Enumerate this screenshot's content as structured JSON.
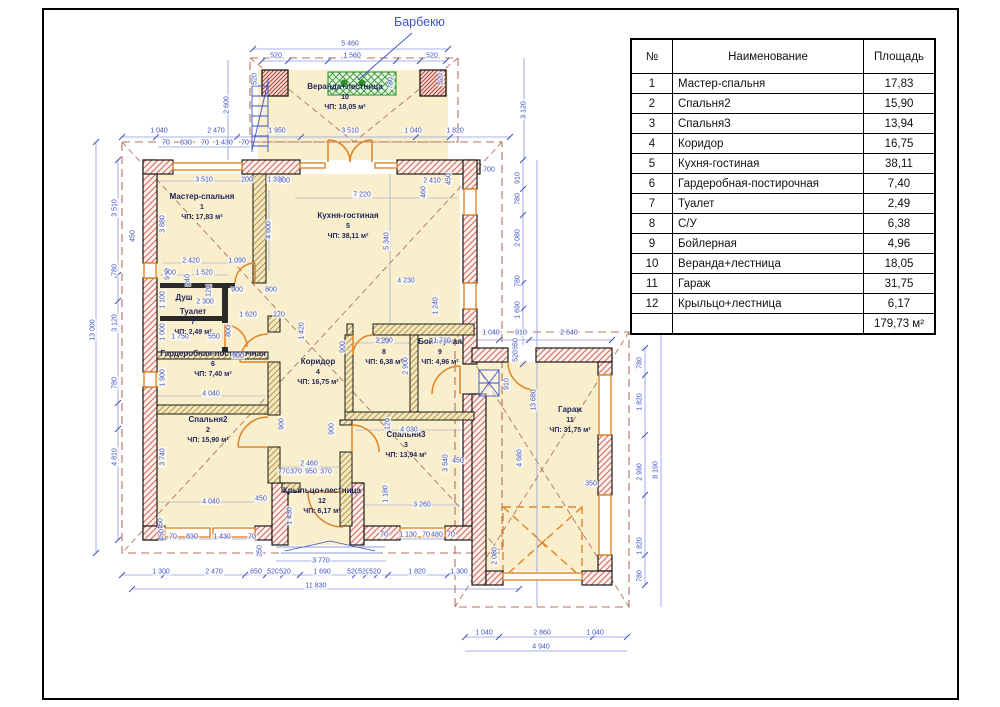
{
  "plan": {
    "barbecue_label": "Барбекю",
    "rooms": [
      {
        "name": "Мастер-спальня",
        "num": "1",
        "area": "ЧП: 17,83 м²",
        "x": 202,
        "y": 207
      },
      {
        "name": "Кухня-гостиная",
        "num": "5",
        "area": "ЧП: 38,11 м²",
        "x": 348,
        "y": 226
      },
      {
        "name": "Душ",
        "num": "",
        "area": "",
        "x": 184,
        "y": 298
      },
      {
        "name": "Туалет",
        "num": "7",
        "area": "ЧП: 2,49 м²",
        "x": 193,
        "y": 322
      },
      {
        "name": "Гардеробная-постирочная",
        "num": "6",
        "area": "ЧП: 7,40 м²",
        "x": 213,
        "y": 364
      },
      {
        "name": "Коридор",
        "num": "4",
        "area": "ЧП: 16,75 м²",
        "x": 318,
        "y": 372
      },
      {
        "name": "Спальня2",
        "num": "2",
        "area": "ЧП: 15,90 м²",
        "x": 208,
        "y": 430
      },
      {
        "name": "С/У",
        "num": "8",
        "area": "ЧП: 6,38 м²",
        "x": 384,
        "y": 352
      },
      {
        "name": "Бойлерная",
        "num": "9",
        "area": "ЧП: 4,96 м²",
        "x": 440,
        "y": 352
      },
      {
        "name": "Спальня3",
        "num": "3",
        "area": "ЧП: 13,94 м²",
        "x": 406,
        "y": 445
      },
      {
        "name": "Крыльцо+лестница",
        "num": "12",
        "area": "ЧП: 6,17 м²",
        "x": 322,
        "y": 501
      },
      {
        "name": "Гараж",
        "num": "11",
        "area": "ЧП: 31,75 м²",
        "x": 570,
        "y": 420
      },
      {
        "name": "Веранда+лестница",
        "num": "10",
        "area": "ЧП: 18,05 м²",
        "x": 345,
        "y": 97
      }
    ],
    "dimensions": [
      {
        "t": "1 040",
        "x": 159,
        "y": 131
      },
      {
        "t": "2 470",
        "x": 216,
        "y": 131
      },
      {
        "t": "1 950",
        "x": 277,
        "y": 131
      },
      {
        "t": "3 510",
        "x": 350,
        "y": 131
      },
      {
        "t": "1 040",
        "x": 413,
        "y": 131
      },
      {
        "t": "1 820",
        "x": 455,
        "y": 131
      },
      {
        "t": "70",
        "x": 166,
        "y": 143
      },
      {
        "t": "830",
        "x": 186,
        "y": 143
      },
      {
        "t": "70",
        "x": 205,
        "y": 143
      },
      {
        "t": "1 430",
        "x": 224,
        "y": 143
      },
      {
        "t": "70",
        "x": 245,
        "y": 143
      },
      {
        "t": "5 460",
        "x": 350,
        "y": 44
      },
      {
        "t": "520",
        "x": 276,
        "y": 56
      },
      {
        "t": "1 560",
        "x": 352,
        "y": 56
      },
      {
        "t": "520",
        "x": 432,
        "y": 56
      },
      {
        "t": "780",
        "x": 391,
        "y": 83,
        "v": 1
      },
      {
        "t": "2 600",
        "x": 227,
        "y": 105,
        "v": 1
      },
      {
        "t": "520",
        "x": 255,
        "y": 79,
        "v": 1
      },
      {
        "t": "520",
        "x": 441,
        "y": 79,
        "v": 1
      },
      {
        "t": "3 120",
        "x": 524,
        "y": 110,
        "v": 1
      },
      {
        "t": "13 000",
        "x": 93,
        "y": 330,
        "v": 1
      },
      {
        "t": "3 510",
        "x": 115,
        "y": 208,
        "v": 1
      },
      {
        "t": "450",
        "x": 133,
        "y": 236,
        "v": 1
      },
      {
        "t": "780",
        "x": 115,
        "y": 270,
        "v": 1
      },
      {
        "t": "3 120",
        "x": 115,
        "y": 323,
        "v": 1
      },
      {
        "t": "780",
        "x": 115,
        "y": 383,
        "v": 1
      },
      {
        "t": "4 810",
        "x": 115,
        "y": 457,
        "v": 1
      },
      {
        "t": "3 880",
        "x": 163,
        "y": 224,
        "v": 1
      },
      {
        "t": "900",
        "x": 168,
        "y": 274,
        "v": 1
      },
      {
        "t": "1 100",
        "x": 163,
        "y": 300,
        "v": 1
      },
      {
        "t": "1 000",
        "x": 163,
        "y": 332,
        "v": 1
      },
      {
        "t": "1 900",
        "x": 163,
        "y": 378,
        "v": 1
      },
      {
        "t": "3 740",
        "x": 163,
        "y": 457,
        "v": 1
      },
      {
        "t": "450",
        "x": 161,
        "y": 524,
        "v": 1
      },
      {
        "t": "3 510",
        "x": 204,
        "y": 180
      },
      {
        "t": "200",
        "x": 247,
        "y": 180
      },
      {
        "t": "1 300",
        "x": 276,
        "y": 180
      },
      {
        "t": "4 600",
        "x": 269,
        "y": 230,
        "v": 1
      },
      {
        "t": "2 420",
        "x": 191,
        "y": 261
      },
      {
        "t": "1 090",
        "x": 237,
        "y": 261
      },
      {
        "t": "900",
        "x": 170,
        "y": 273
      },
      {
        "t": "1 520",
        "x": 204,
        "y": 273
      },
      {
        "t": "900",
        "x": 237,
        "y": 290
      },
      {
        "t": "800",
        "x": 271,
        "y": 290
      },
      {
        "t": "2 300",
        "x": 205,
        "y": 302
      },
      {
        "t": "1 620",
        "x": 248,
        "y": 315
      },
      {
        "t": "270",
        "x": 279,
        "y": 315
      },
      {
        "t": "120",
        "x": 209,
        "y": 291,
        "v": 1
      },
      {
        "t": "240",
        "x": 188,
        "y": 280,
        "v": 1
      },
      {
        "t": "1 420",
        "x": 302,
        "y": 331,
        "v": 1
      },
      {
        "t": "900",
        "x": 343,
        "y": 347,
        "v": 1
      },
      {
        "t": "800",
        "x": 284,
        "y": 181
      },
      {
        "t": "7 220",
        "x": 362,
        "y": 195
      },
      {
        "t": "2 410",
        "x": 432,
        "y": 181
      },
      {
        "t": "460",
        "x": 424,
        "y": 192,
        "v": 1
      },
      {
        "t": "450",
        "x": 449,
        "y": 179,
        "v": 1
      },
      {
        "t": "5 340",
        "x": 387,
        "y": 241,
        "v": 1
      },
      {
        "t": "4 230",
        "x": 406,
        "y": 281
      },
      {
        "t": "1 240",
        "x": 436,
        "y": 306,
        "v": 1
      },
      {
        "t": "700",
        "x": 489,
        "y": 170
      },
      {
        "t": "910",
        "x": 518,
        "y": 178,
        "v": 1
      },
      {
        "t": "780",
        "x": 518,
        "y": 199,
        "v": 1
      },
      {
        "t": "2 080",
        "x": 518,
        "y": 238,
        "v": 1
      },
      {
        "t": "780",
        "x": 518,
        "y": 281,
        "v": 1
      },
      {
        "t": "1 690",
        "x": 518,
        "y": 310,
        "v": 1
      },
      {
        "t": "13 680",
        "x": 534,
        "y": 400,
        "v": 1
      },
      {
        "t": "1 750",
        "x": 180,
        "y": 337
      },
      {
        "t": "550",
        "x": 214,
        "y": 337
      },
      {
        "t": "800",
        "x": 229,
        "y": 331,
        "v": 1
      },
      {
        "t": "900",
        "x": 238,
        "y": 356
      },
      {
        "t": "4 040",
        "x": 211,
        "y": 394
      },
      {
        "t": "900",
        "x": 282,
        "y": 424,
        "v": 1
      },
      {
        "t": "900",
        "x": 332,
        "y": 429,
        "v": 1
      },
      {
        "t": "2 200",
        "x": 384,
        "y": 341
      },
      {
        "t": "1 710",
        "x": 442,
        "y": 341
      },
      {
        "t": "2 900",
        "x": 406,
        "y": 366,
        "v": 1
      },
      {
        "t": "4 030",
        "x": 409,
        "y": 430
      },
      {
        "t": "120",
        "x": 388,
        "y": 424,
        "v": 1
      },
      {
        "t": "3 540",
        "x": 446,
        "y": 463,
        "v": 1
      },
      {
        "t": "450",
        "x": 458,
        "y": 461
      },
      {
        "t": "1 180",
        "x": 386,
        "y": 494,
        "v": 1
      },
      {
        "t": "3 260",
        "x": 422,
        "y": 505
      },
      {
        "t": "1 040",
        "x": 491,
        "y": 333
      },
      {
        "t": "910",
        "x": 521,
        "y": 333
      },
      {
        "t": "2 640",
        "x": 569,
        "y": 333
      },
      {
        "t": "650",
        "x": 516,
        "y": 344,
        "v": 1
      },
      {
        "t": "520",
        "x": 516,
        "y": 356,
        "v": 1
      },
      {
        "t": "910",
        "x": 507,
        "y": 384,
        "v": 1
      },
      {
        "t": "4 680",
        "x": 520,
        "y": 458,
        "v": 1
      },
      {
        "t": "350",
        "x": 591,
        "y": 484
      },
      {
        "t": "2 080",
        "x": 495,
        "y": 556,
        "v": 1
      },
      {
        "t": "780",
        "x": 640,
        "y": 363,
        "v": 1
      },
      {
        "t": "1 820",
        "x": 640,
        "y": 402,
        "v": 1
      },
      {
        "t": "2 990",
        "x": 640,
        "y": 472,
        "v": 1
      },
      {
        "t": "1 820",
        "x": 640,
        "y": 546,
        "v": 1
      },
      {
        "t": "780",
        "x": 640,
        "y": 576,
        "v": 1
      },
      {
        "t": "8 190",
        "x": 656,
        "y": 470,
        "v": 1
      },
      {
        "t": "4 040",
        "x": 211,
        "y": 502
      },
      {
        "t": "450",
        "x": 261,
        "y": 499
      },
      {
        "t": "1 430",
        "x": 290,
        "y": 516,
        "v": 1
      },
      {
        "t": "2 460",
        "x": 309,
        "y": 464
      },
      {
        "t": "770",
        "x": 284,
        "y": 472
      },
      {
        "t": "370",
        "x": 296,
        "y": 472
      },
      {
        "t": "950",
        "x": 311,
        "y": 472
      },
      {
        "t": "370",
        "x": 326,
        "y": 472
      },
      {
        "t": "450",
        "x": 162,
        "y": 535,
        "v": 1
      },
      {
        "t": "70",
        "x": 173,
        "y": 537
      },
      {
        "t": "830",
        "x": 192,
        "y": 537
      },
      {
        "t": "1 430",
        "x": 222,
        "y": 537
      },
      {
        "t": "70",
        "x": 252,
        "y": 537
      },
      {
        "t": "250",
        "x": 260,
        "y": 551,
        "v": 1
      },
      {
        "t": "70",
        "x": 384,
        "y": 535
      },
      {
        "t": "1 130",
        "x": 408,
        "y": 535
      },
      {
        "t": "70",
        "x": 426,
        "y": 535
      },
      {
        "t": "480",
        "x": 437,
        "y": 535
      },
      {
        "t": "70",
        "x": 451,
        "y": 535
      },
      {
        "t": "3 770",
        "x": 321,
        "y": 561
      },
      {
        "t": "1 300",
        "x": 161,
        "y": 572
      },
      {
        "t": "2 470",
        "x": 214,
        "y": 572
      },
      {
        "t": "650",
        "x": 256,
        "y": 572
      },
      {
        "t": "520",
        "x": 273,
        "y": 572
      },
      {
        "t": "520",
        "x": 285,
        "y": 572
      },
      {
        "t": "1 690",
        "x": 322,
        "y": 572
      },
      {
        "t": "520",
        "x": 353,
        "y": 572
      },
      {
        "t": "520",
        "x": 364,
        "y": 572
      },
      {
        "t": "520",
        "x": 375,
        "y": 572
      },
      {
        "t": "1 820",
        "x": 417,
        "y": 572
      },
      {
        "t": "1 300",
        "x": 459,
        "y": 572
      },
      {
        "t": "11 830",
        "x": 316,
        "y": 586
      },
      {
        "t": "1 040",
        "x": 484,
        "y": 633
      },
      {
        "t": "2 860",
        "x": 542,
        "y": 633
      },
      {
        "t": "1 040",
        "x": 595,
        "y": 633
      },
      {
        "t": "4 940",
        "x": 541,
        "y": 647
      }
    ]
  },
  "table": {
    "headers": [
      "№",
      "Наименование",
      "Площадь"
    ],
    "rows": [
      [
        "1",
        "Мастер-спальня",
        "17,83"
      ],
      [
        "2",
        "Спальня2",
        "15,90"
      ],
      [
        "3",
        "Спальня3",
        "13,94"
      ],
      [
        "4",
        "Коридор",
        "16,75"
      ],
      [
        "5",
        "Кухня-гостиная",
        "38,11"
      ],
      [
        "6",
        "Гардеробная-постирочная",
        "7,40"
      ],
      [
        "7",
        "Туалет",
        "2,49"
      ],
      [
        "8",
        "С/У",
        "6,38"
      ],
      [
        "9",
        "Бойлерная",
        "4,96"
      ],
      [
        "10",
        "Веранда+лестница",
        "18,05"
      ],
      [
        "11",
        "Гараж",
        "31,75"
      ],
      [
        "12",
        "Крыльцо+лестница",
        "6,17"
      ]
    ],
    "total": "179,73 м²"
  }
}
